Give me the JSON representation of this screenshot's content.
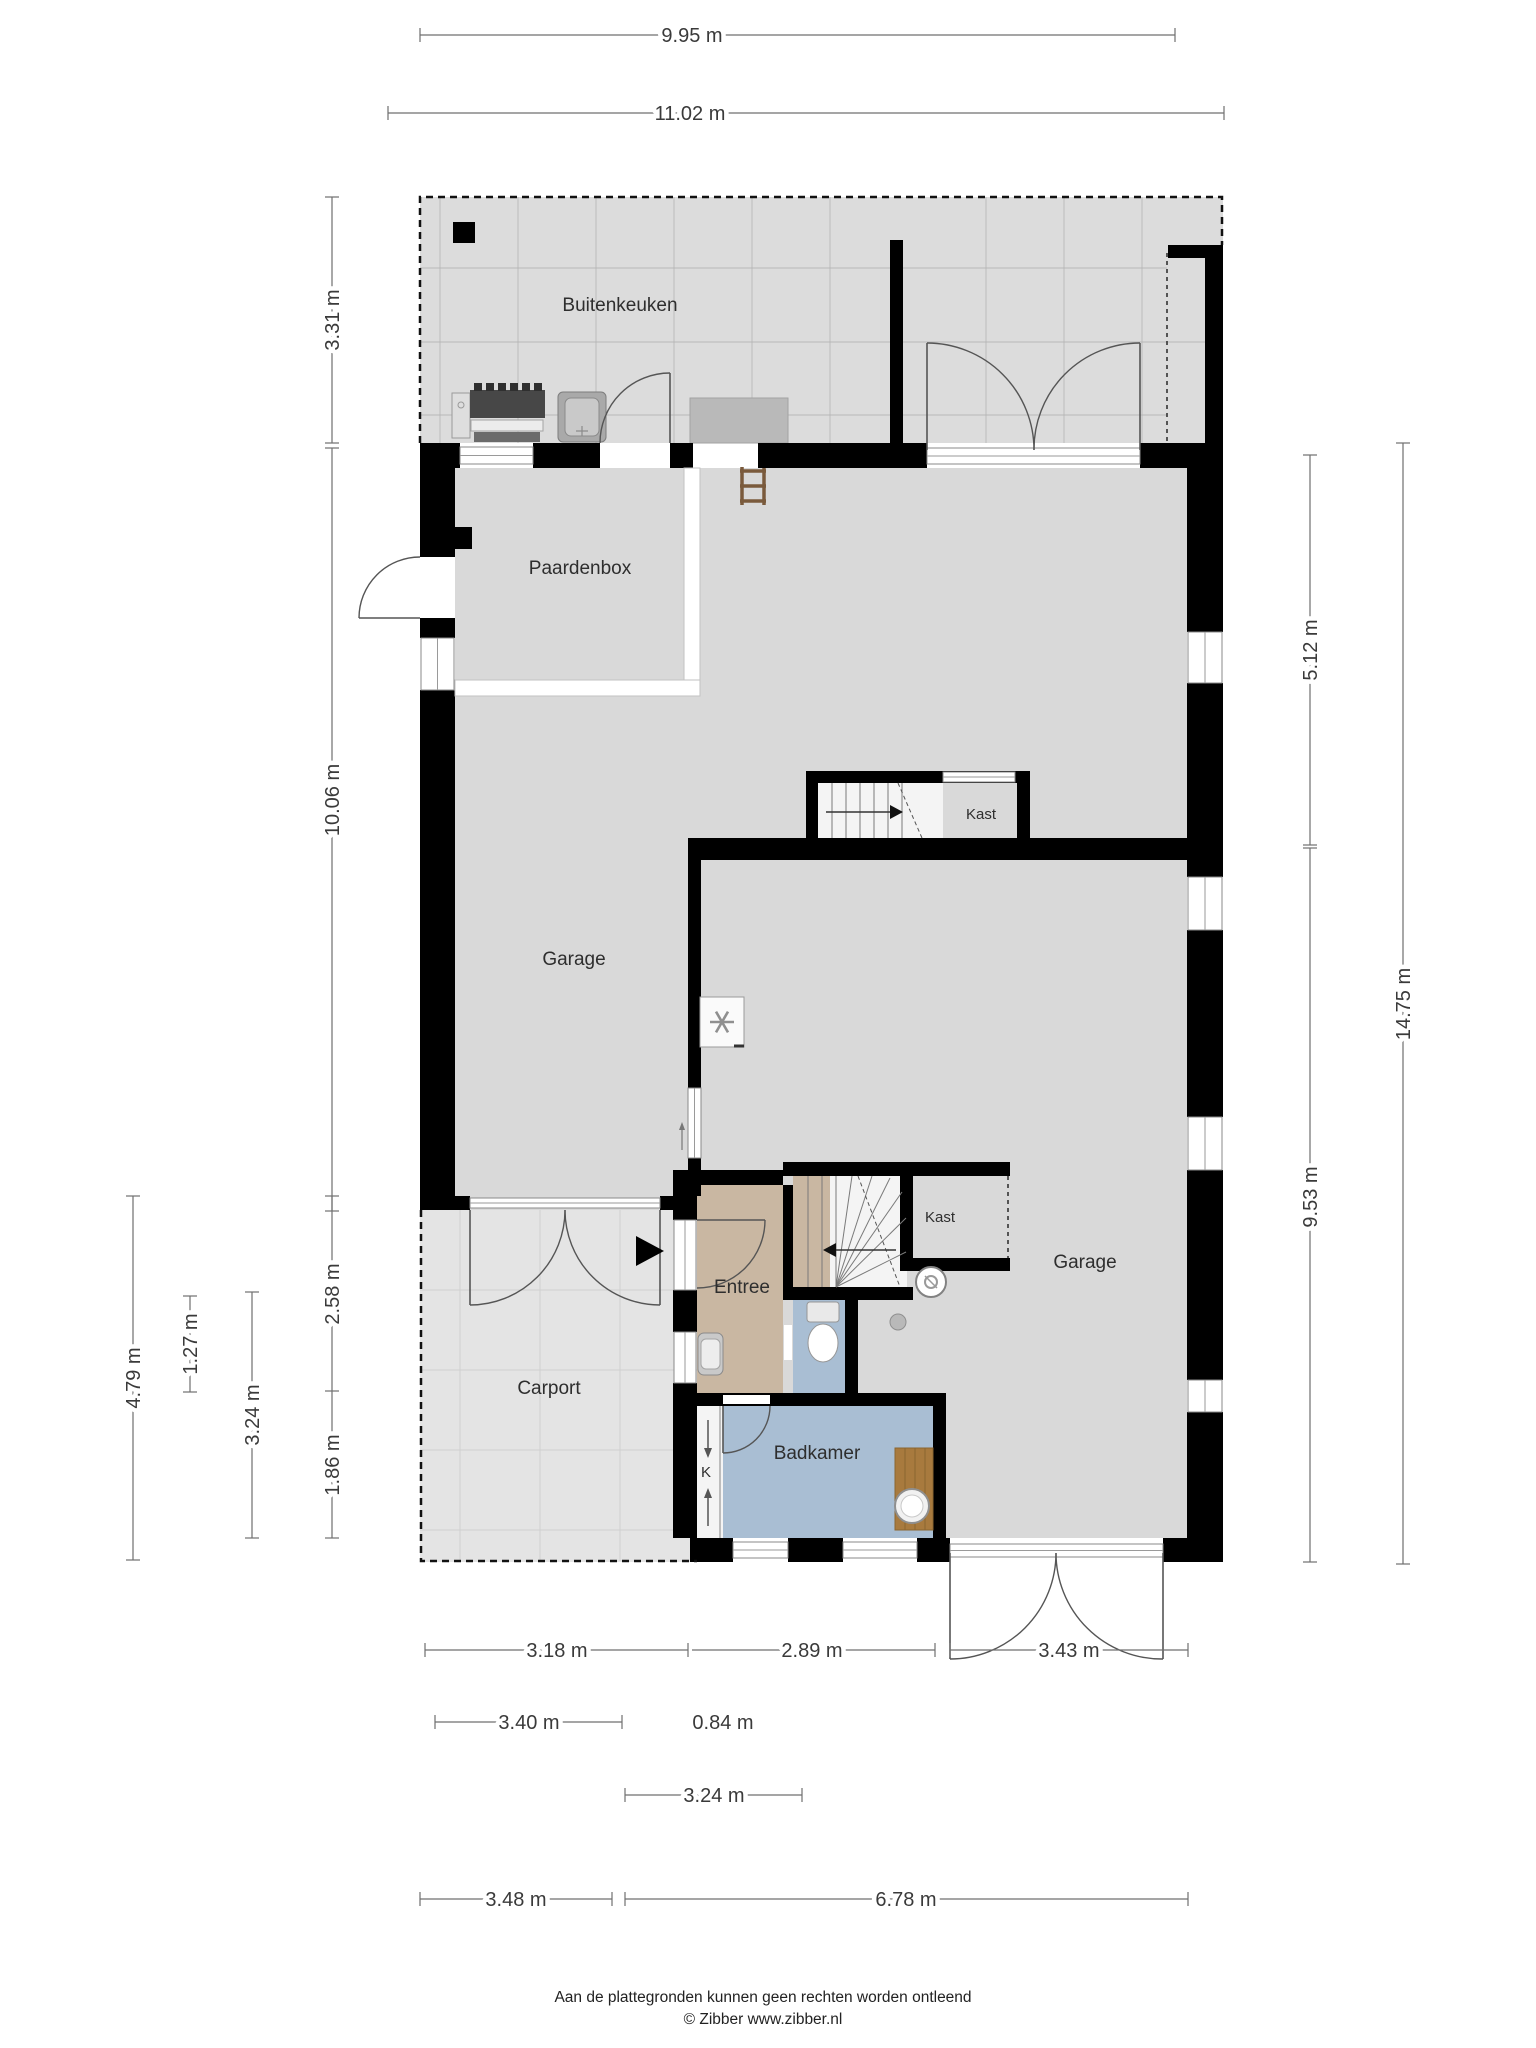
{
  "plan": {
    "title": "Begane grond plattegrond",
    "rooms": {
      "buitenkeuken": "Buitenkeuken",
      "paardenbox": "Paardenbox",
      "garage_left": "Garage",
      "garage_right": "Garage",
      "kast_upper": "Kast",
      "kast_lower": "Kast",
      "entree": "Entree",
      "carport": "Carport",
      "badkamer": "Badkamer",
      "closet_k": "K"
    },
    "dimensions": {
      "top": [
        "9.95 m",
        "11.02 m"
      ],
      "left": [
        "3.31 m",
        "10.06 m",
        "2.58 m",
        "1.86 m",
        "3.24 m",
        "1.27 m",
        "4.79 m"
      ],
      "right": [
        "5.12 m",
        "9.53 m",
        "14.75 m"
      ],
      "bottom": [
        [
          "3.18 m",
          "2.89 m",
          "3.43 m"
        ],
        [
          "3.40 m",
          "0.84 m"
        ],
        [
          "3.24 m"
        ],
        [
          "3.48 m",
          "6.78 m"
        ]
      ]
    },
    "icons": {
      "grill": "grill-icon",
      "sink_outdoor": "sink-icon",
      "ladder": "ladder-icon",
      "fan": "ventilation-icon",
      "washer": "washing-machine-icon",
      "toilet": "toilet-icon",
      "bath": "bath-icon",
      "sink_entree": "sink-icon",
      "entrance_arrow": "entrance-arrow-icon",
      "stairs": "stairs-icon"
    },
    "colors": {
      "wall": "#000000",
      "interior_floor": "#d9d9d9",
      "outdoor_floor": "#dcdcdc",
      "carport_floor": "#e4e4e4",
      "entree_floor": "#c9b7a2",
      "bathroom_floor": "#a9bed3",
      "bath_wood": "#a87a3e",
      "dimension_line": "#6f6f6f"
    }
  },
  "footer": {
    "disclaimer": "Aan de plattegronden kunnen geen rechten worden ontleend",
    "copyright": "© Zibber www.zibber.nl"
  }
}
